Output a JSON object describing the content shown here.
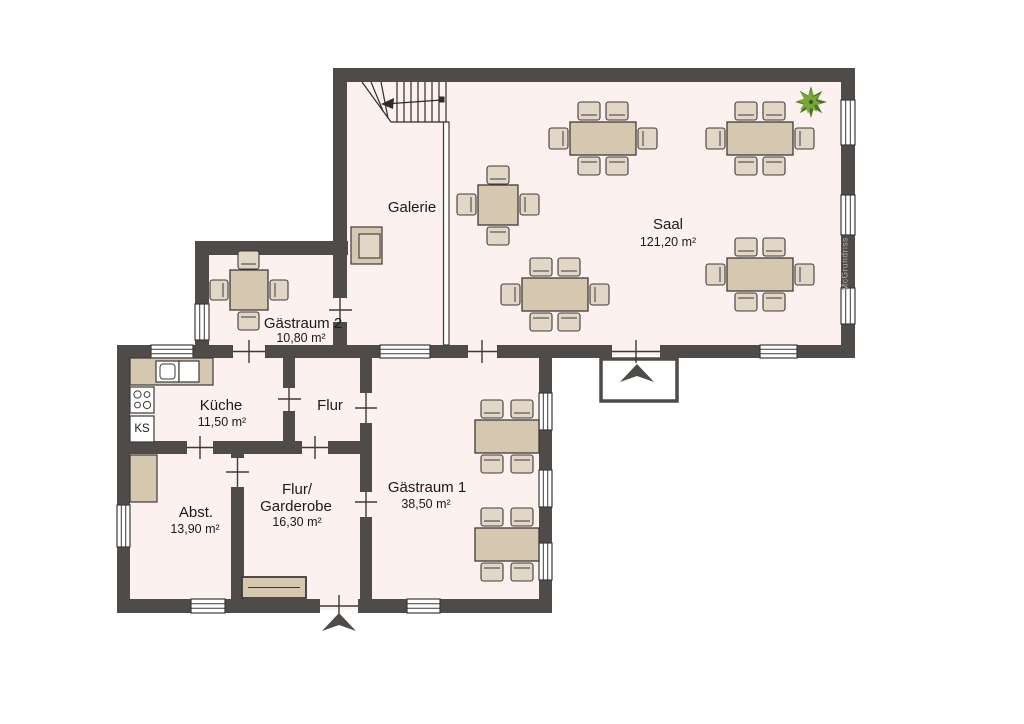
{
  "watermark": "McGrundriss",
  "rooms": {
    "saal": {
      "name": "Saal",
      "area": "121,20 m²"
    },
    "galerie": {
      "name": "Galerie"
    },
    "gaestraum2": {
      "name": "Gästraum 2",
      "area": "10,80 m²"
    },
    "kueche": {
      "name": "Küche",
      "area": "11,50 m²"
    },
    "flur": {
      "name": "Flur"
    },
    "abstellraum": {
      "name": "Abst.",
      "area": "13,90 m²"
    },
    "flur_garderobe": {
      "name_line1": "Flur/",
      "name_line2": "Garderobe",
      "area": "16,30 m²"
    },
    "gaestraum1": {
      "name": "Gästraum 1",
      "area": "38,50 m²"
    }
  },
  "appliances": {
    "fridge_label": "KS"
  },
  "colors": {
    "wall": "#4f4b49",
    "floor": "#fcf1ef",
    "furniture_table": "#d6c7b1",
    "furniture_chair": "#e2d7c6",
    "plant_dark": "#49761f",
    "plant_light": "#7aa838",
    "text": "#1a1a1a",
    "watermark_text": "#b6b2ae",
    "background": "#ffffff"
  }
}
